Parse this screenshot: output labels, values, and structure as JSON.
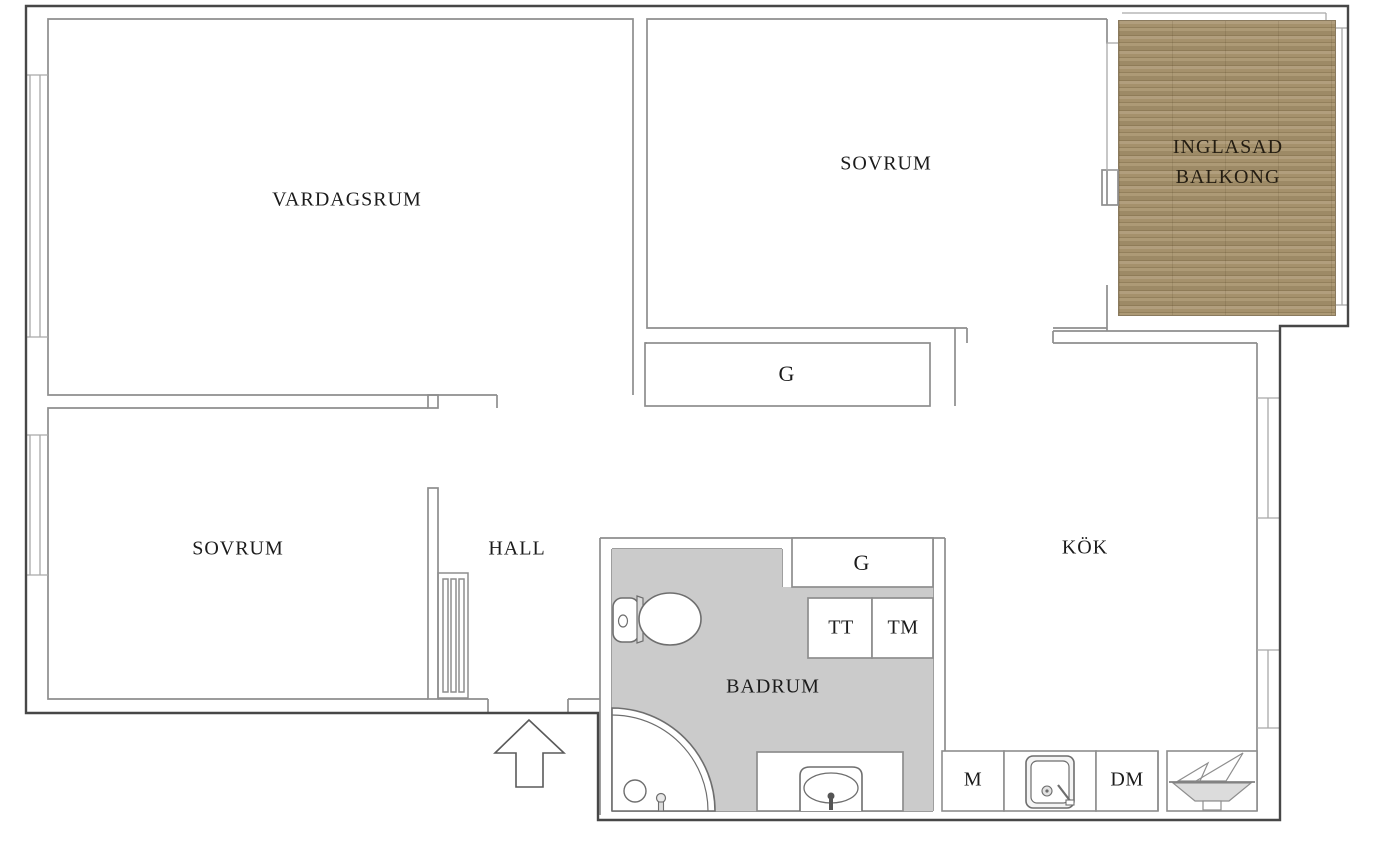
{
  "floorplan": {
    "labels": {
      "vardagsrum": "VARDAGSRUM",
      "sovrum_top": "SOVRUM",
      "balkong_line1": "INGLASAD",
      "balkong_line2": "BALKONG",
      "garderob_sovrum": "G",
      "sovrum_bottom": "SOVRUM",
      "hall": "HALL",
      "garderob_badrum": "G",
      "torktumlare": "TT",
      "tvattmaskin": "TM",
      "badrum": "BADRUM",
      "kok": "KÖK",
      "m_unit": "M",
      "diskmaskin": "DM"
    },
    "colors": {
      "wall_outer": "#474747",
      "wall_inner": "#8e8e8e",
      "window_line": "#a9a9a9",
      "bathroom_fill": "#cbcbcb",
      "balcony_wood": "#a9966f",
      "balcony_wood_dark": "#8f7c58",
      "fixture_line": "#6e6e6e",
      "label_text": "#1b1b1b",
      "background": "#ffffff"
    },
    "icons": [
      "toilet-icon",
      "shower-corner-icon",
      "floor-drain-icon",
      "shower-mixer-icon",
      "washbasin-icon",
      "radiator-icon",
      "kitchen-sink-icon",
      "stove-icon",
      "entrance-arrow-icon",
      "window-icon"
    ]
  }
}
